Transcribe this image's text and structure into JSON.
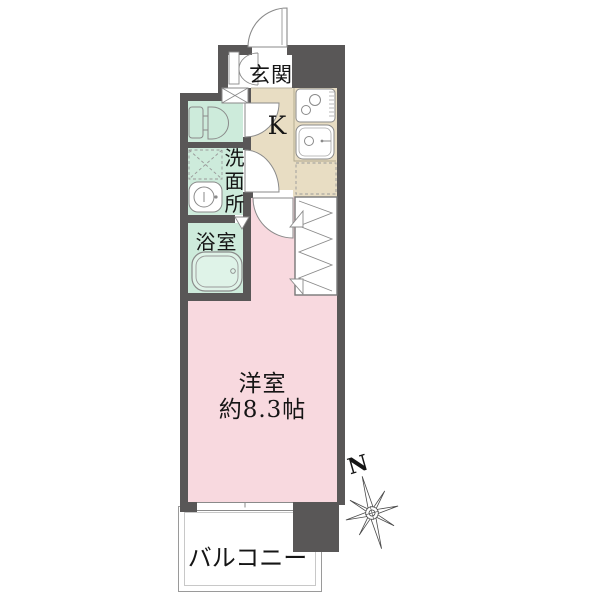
{
  "plan_type": "floor-plan",
  "rooms": {
    "genkan": {
      "label": "玄関"
    },
    "kitchen": {
      "label": "K"
    },
    "washroom": {
      "label": "洗面所"
    },
    "bathroom": {
      "label": "浴室"
    },
    "western_room": {
      "label": "洋室",
      "size": "約8.3帖"
    },
    "balcony": {
      "label": "バルコニー"
    }
  },
  "compass": {
    "north_label": "N"
  },
  "colors": {
    "wall": "#595757",
    "kitchen_floor": "#e8ddc3",
    "wet_area_floor": "#cdebdb",
    "room_floor": "#f8d9df",
    "fixture_line": "#8a8a8a"
  }
}
